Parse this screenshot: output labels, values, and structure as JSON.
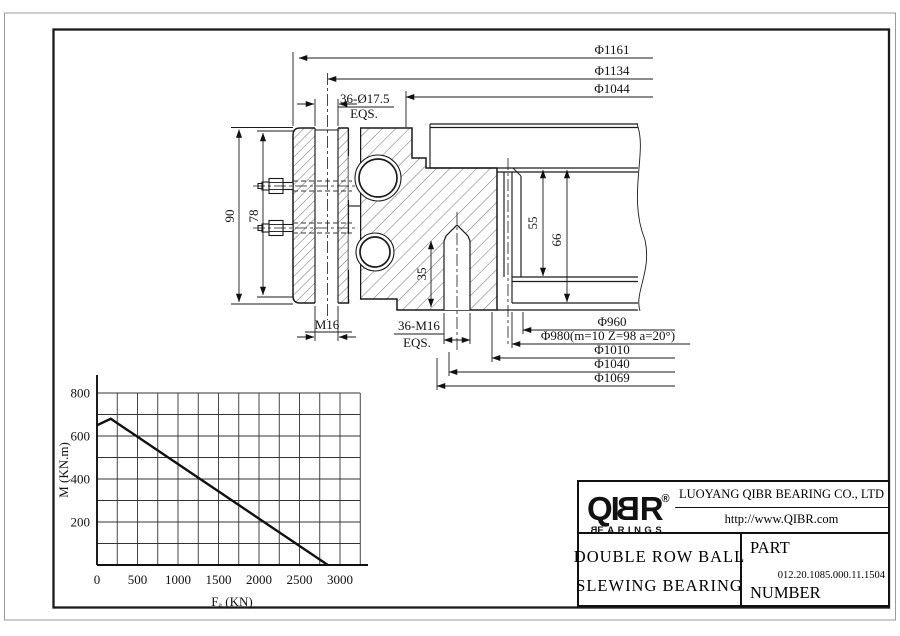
{
  "page": {
    "bg": "#ffffff",
    "line_color": "#1a1a1a",
    "frame_color": "#1a1a1a"
  },
  "drawing": {
    "top_dims": [
      "Φ1161",
      "Φ1134",
      "Φ1044"
    ],
    "bolt_holes_label": "36-Ø17.5",
    "eqs": "EQS.",
    "height_dims": [
      "90",
      "78"
    ],
    "bolt_thread_label": "M16",
    "tapped_holes_label": "36-M16",
    "tapped_depth": "35",
    "seat_dims": [
      "55",
      "66"
    ],
    "bottom_dims": [
      "Φ960",
      "Φ980(m=10 Z=98 a=20°)",
      "Φ1010",
      "Φ1040",
      "Φ1069"
    ]
  },
  "chart_data": {
    "type": "line",
    "title": "",
    "xlabel": "Fₐ (KN)",
    "ylabel": "M (KN.m)",
    "xlim": [
      0,
      3250
    ],
    "ylim": [
      0,
      800
    ],
    "grid": {
      "on": true,
      "x_step": 250,
      "y_step": 100
    },
    "x_ticks": [
      0,
      500,
      1000,
      1500,
      2000,
      2500,
      3000
    ],
    "x_tick_labels": [
      "0",
      "500",
      "1000",
      "1500",
      "2000",
      "2500",
      "3000"
    ],
    "y_ticks": [
      200,
      400,
      600,
      800
    ],
    "y_tick_labels": [
      "200",
      "400",
      "600",
      "800"
    ],
    "series": [
      {
        "name": "static load limit curve",
        "points": [
          [
            0,
            650
          ],
          [
            170,
            680
          ],
          [
            2850,
            0
          ]
        ]
      }
    ],
    "legend": null
  },
  "title_block": {
    "logo": {
      "p1": "QI",
      "p2": "B",
      "p3": "R",
      "reg": "®",
      "sub_b": "B",
      "sub_rest": "EARINGS"
    },
    "company": "LUOYANG QIBR BEARING CO., LTD",
    "website": "http://www.QIBR.com",
    "product": [
      "DOUBLE ROW BALL",
      "SLEWING BEARING"
    ],
    "part_label": [
      "PART",
      "NUMBER"
    ],
    "part_number": "012.20.1085.000.11.1504"
  }
}
